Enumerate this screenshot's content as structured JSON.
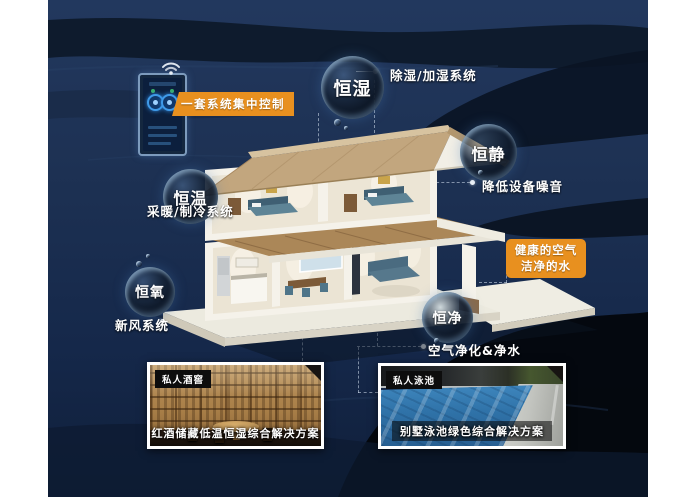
{
  "colors": {
    "accent_orange": "#e8901f",
    "background_navy": "#1d3153",
    "text_white": "#ffffff"
  },
  "control": {
    "label": "一套系统集中控制",
    "device": "smart home control panel",
    "icon": "wifi-icon"
  },
  "features": [
    {
      "name": "恒湿",
      "description": "除湿/加湿系统"
    },
    {
      "name": "恒静",
      "description": "降低设备噪音"
    },
    {
      "name": "恒温",
      "description": "采暖/制冷系统"
    },
    {
      "name": "恒氧",
      "description": "新风系统"
    },
    {
      "name": "恒净",
      "description": "空气净化&净水"
    }
  ],
  "highlight": {
    "line1": "健康的空气",
    "line2": "洁净的水"
  },
  "photos": [
    {
      "tag": "私人酒窖",
      "caption": "红酒储藏低温恒湿综合解决方案"
    },
    {
      "tag": "私人泳池",
      "caption": "别墅泳池绿色综合解决方案"
    }
  ]
}
